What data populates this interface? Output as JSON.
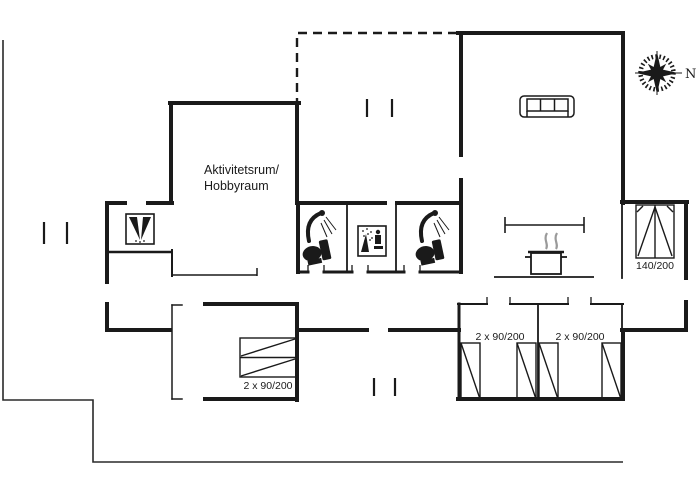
{
  "colors": {
    "wall": "#1a1a1a",
    "boundary": "#2a2a2a",
    "steam": "#9a9a9a",
    "background": "#ffffff"
  },
  "rooms": {
    "activity_room": {
      "line1": "Aktivitetsrum/",
      "line2": "Hobbyraum"
    }
  },
  "beds": {
    "double_bed_label": "140/200",
    "bunk_bed_label": "2 x 90/200",
    "twin_left_label": "2 x 90/200",
    "twin_right_label": "2 x 90/200"
  },
  "compass": {
    "north_label": "N"
  },
  "icons": {
    "compass": "compass-rose",
    "living_room": "sofa",
    "entry_room": "washbasin",
    "bathroom_1": [
      "shower",
      "toilet"
    ],
    "tech_room": "whirlpool-spray",
    "bathroom_2": [
      "shower",
      "toilet"
    ],
    "kitchen": [
      "cooking-pot",
      "steam"
    ]
  }
}
